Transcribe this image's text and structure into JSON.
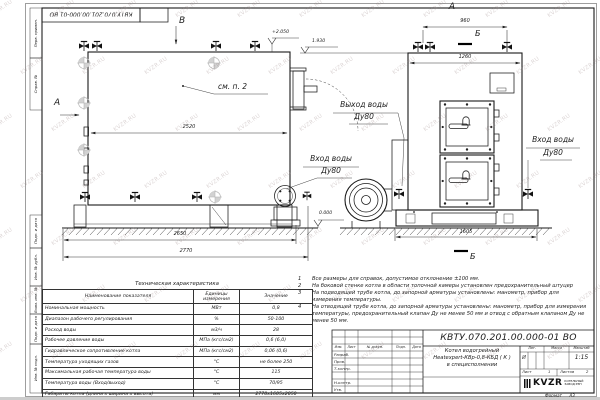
{
  "page": {
    "watermark": "KVZR.RU"
  },
  "frame": {
    "side_labels": [
      "Перв. примен.",
      "Справ. №",
      "Подп. и дата",
      "Инв. № дубл.",
      "Взам. инв. №",
      "Подп. и дата",
      "Инв. № подл."
    ]
  },
  "views": {
    "side": {
      "letter_top": "В",
      "letter_left": "А",
      "see_note": "см. п. 2",
      "dim_length_body": "2520",
      "dim_length_mid": "2650",
      "dim_length_overall": "2770",
      "elev_top": "+2.050",
      "elev_pipe": "1.930",
      "elev_ground": "0.000",
      "outlet_label": [
        "Выход воды",
        "Ду80"
      ],
      "inlet_label": [
        "Вход воды",
        "Ду80"
      ]
    },
    "front": {
      "letter_top": "А",
      "section_letter": "Б",
      "dim_valves": "960",
      "dim_width_body": "1260",
      "dim_width_overall": "1605",
      "inlet_label": [
        "Вход воды",
        "Ду80"
      ]
    }
  },
  "notes": [
    {
      "n": "1",
      "text": "Все размеры для справок, допустимое отклонение ±100 мм."
    },
    {
      "n": "2",
      "text": "На боковой стенке котла в области топочной камеры установлен предохранительный штуцер"
    },
    {
      "n": "3",
      "text": "На подводящей трубе котла, до запорной арматуры установлены: манометр, прибор для измерения температуры."
    },
    {
      "n": "4",
      "text": "На отводящей трубе котла, до запорной арматуры установлены: манометр, прибор для измерения температуры, предохранительный клапан Ду не менее 50 мм и отвод с обратным клапаном Ду не менее 50 мм."
    }
  ],
  "spec_table": {
    "title": "Техническая характеристика",
    "headers": [
      "Наименование показателя",
      "Единицы измерения",
      "Значение"
    ],
    "rows": [
      [
        "Номинальная мощность",
        "МВт",
        "0,8"
      ],
      [
        "Диапазон рабочего регулирования",
        "%",
        "50-100"
      ],
      [
        "Расход воды",
        "м3/ч",
        "28"
      ],
      [
        "Рабочее давление воды",
        "МПа (кгс/см2)",
        "0,6 (6,0)"
      ],
      [
        "Гидравлическое сопротивление котла",
        "МПа (кгс/см2)",
        "0,06 (0,6)"
      ],
      [
        "Температура уходящих газов",
        "°С",
        "не более 250"
      ],
      [
        "Максимальная рабочая температура воды",
        "°С",
        "115"
      ],
      [
        "Температура воды (Вход/выход)",
        "°С",
        "70/95"
      ],
      [
        "Габариты котла (длина х ширина х высота)",
        "мм",
        "2770х1605х2050"
      ]
    ]
  },
  "title_block": {
    "doc_number": "КВТУ.070.201.00.000-01 ВО",
    "product": [
      "Котел водогрейный",
      "Heatexpert-КВр-0,8-КБД ( К )",
      "в специсполнении"
    ],
    "cols": [
      "Изм.",
      "Лист",
      "№ докум.",
      "Подп.",
      "Дата"
    ],
    "rows": [
      "Разраб.",
      "Пров.",
      "Т.контр.",
      "Н.контр.",
      "Утв."
    ],
    "lit_label": "Лит.",
    "mass_label": "Масса",
    "scale_label": "Масштаб",
    "lit": "И",
    "scale": "1:15",
    "sheet_label": "Лист",
    "sheet": "1",
    "sheets_label": "Листов",
    "sheets": "2",
    "logo": "KVZR",
    "company": [
      "КОТЕЛЬНЫЙ",
      "ЗАВОД РЭП"
    ],
    "format_label": "Формат",
    "format": "А3"
  }
}
